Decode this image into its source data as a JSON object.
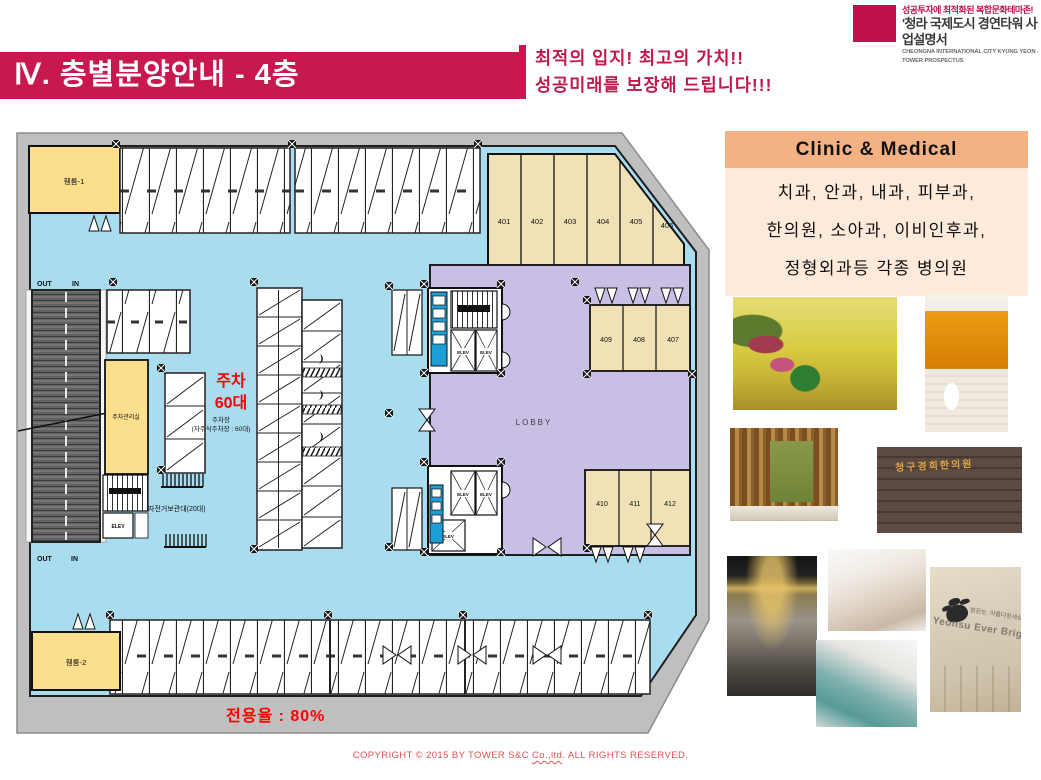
{
  "header": {
    "title": "Ⅳ. 층별분양안내 - 4층",
    "slogan_line1": "최적의 입지!  최고의 가치!!",
    "slogan_line2": "성공미래를 보장해 드립니다!!!",
    "logo": {
      "tagline": "성공투자에 최적화된 복합문화테마존!",
      "name": "'청라 국제도시 경연타워 사업설명서",
      "name_en": "CHEONGNA INTERNATIONAL CITY KYUNG YEON - TOWER PROSPECTUS"
    }
  },
  "clinic_panel": {
    "title": "Clinic  &  Medical",
    "line1": "치과, 안과, 내과, 피부과,",
    "line2": "한의원, 소아과, 이비인후과,",
    "line3": "정형외과등 각종 병의원"
  },
  "floor_plan": {
    "fan_room_1": "휀룸-1",
    "fan_room_2": "휀룸-2",
    "unit_numbers_top": [
      "401",
      "402",
      "403",
      "404",
      "405",
      "406"
    ],
    "unit_numbers_mid": [
      "409",
      "408",
      "407"
    ],
    "unit_numbers_bottom": [
      "410",
      "411",
      "412"
    ],
    "lobby": "LOBBY",
    "elevator": "ELEV",
    "parking_office": "주차관리실",
    "bike_rack": "자전거보관대(20대)",
    "parking_big_line1": "주차",
    "parking_big_line2": "60대",
    "parking_sub_line1": "주차장",
    "parking_sub_line2": "(자주식주차장 : 60대)",
    "out_label": "OUT",
    "in_label": "IN",
    "exclusive_rate": "전용율 : 80%"
  },
  "photos": {
    "sign_hanuiwon": "청구경희한의원",
    "sign_yeonsu_ko": "밝은눈, 아름다운세상",
    "sign_yeonsu_en": "Yeonsu  Ever Bright Eye"
  },
  "footer": {
    "copyright_pre": "COPYRIGHT © 2015 BY TOWER S&C ",
    "copyright_underline": "Co.,ltd",
    "copyright_post": ". ALL RIGHTS RESERVED."
  },
  "colors": {
    "title_bar": "#C81850",
    "accent_red": "#FF0000",
    "clinic_header": "#F4B183",
    "clinic_body": "#FDEADB",
    "floor_blue": "#A9DCEF",
    "room_yellow": "#FBDF8D",
    "room_beige": "#F0E2B6",
    "lobby_purple": "#C9BFE5",
    "shaft_blue": "#1C9FD6"
  }
}
